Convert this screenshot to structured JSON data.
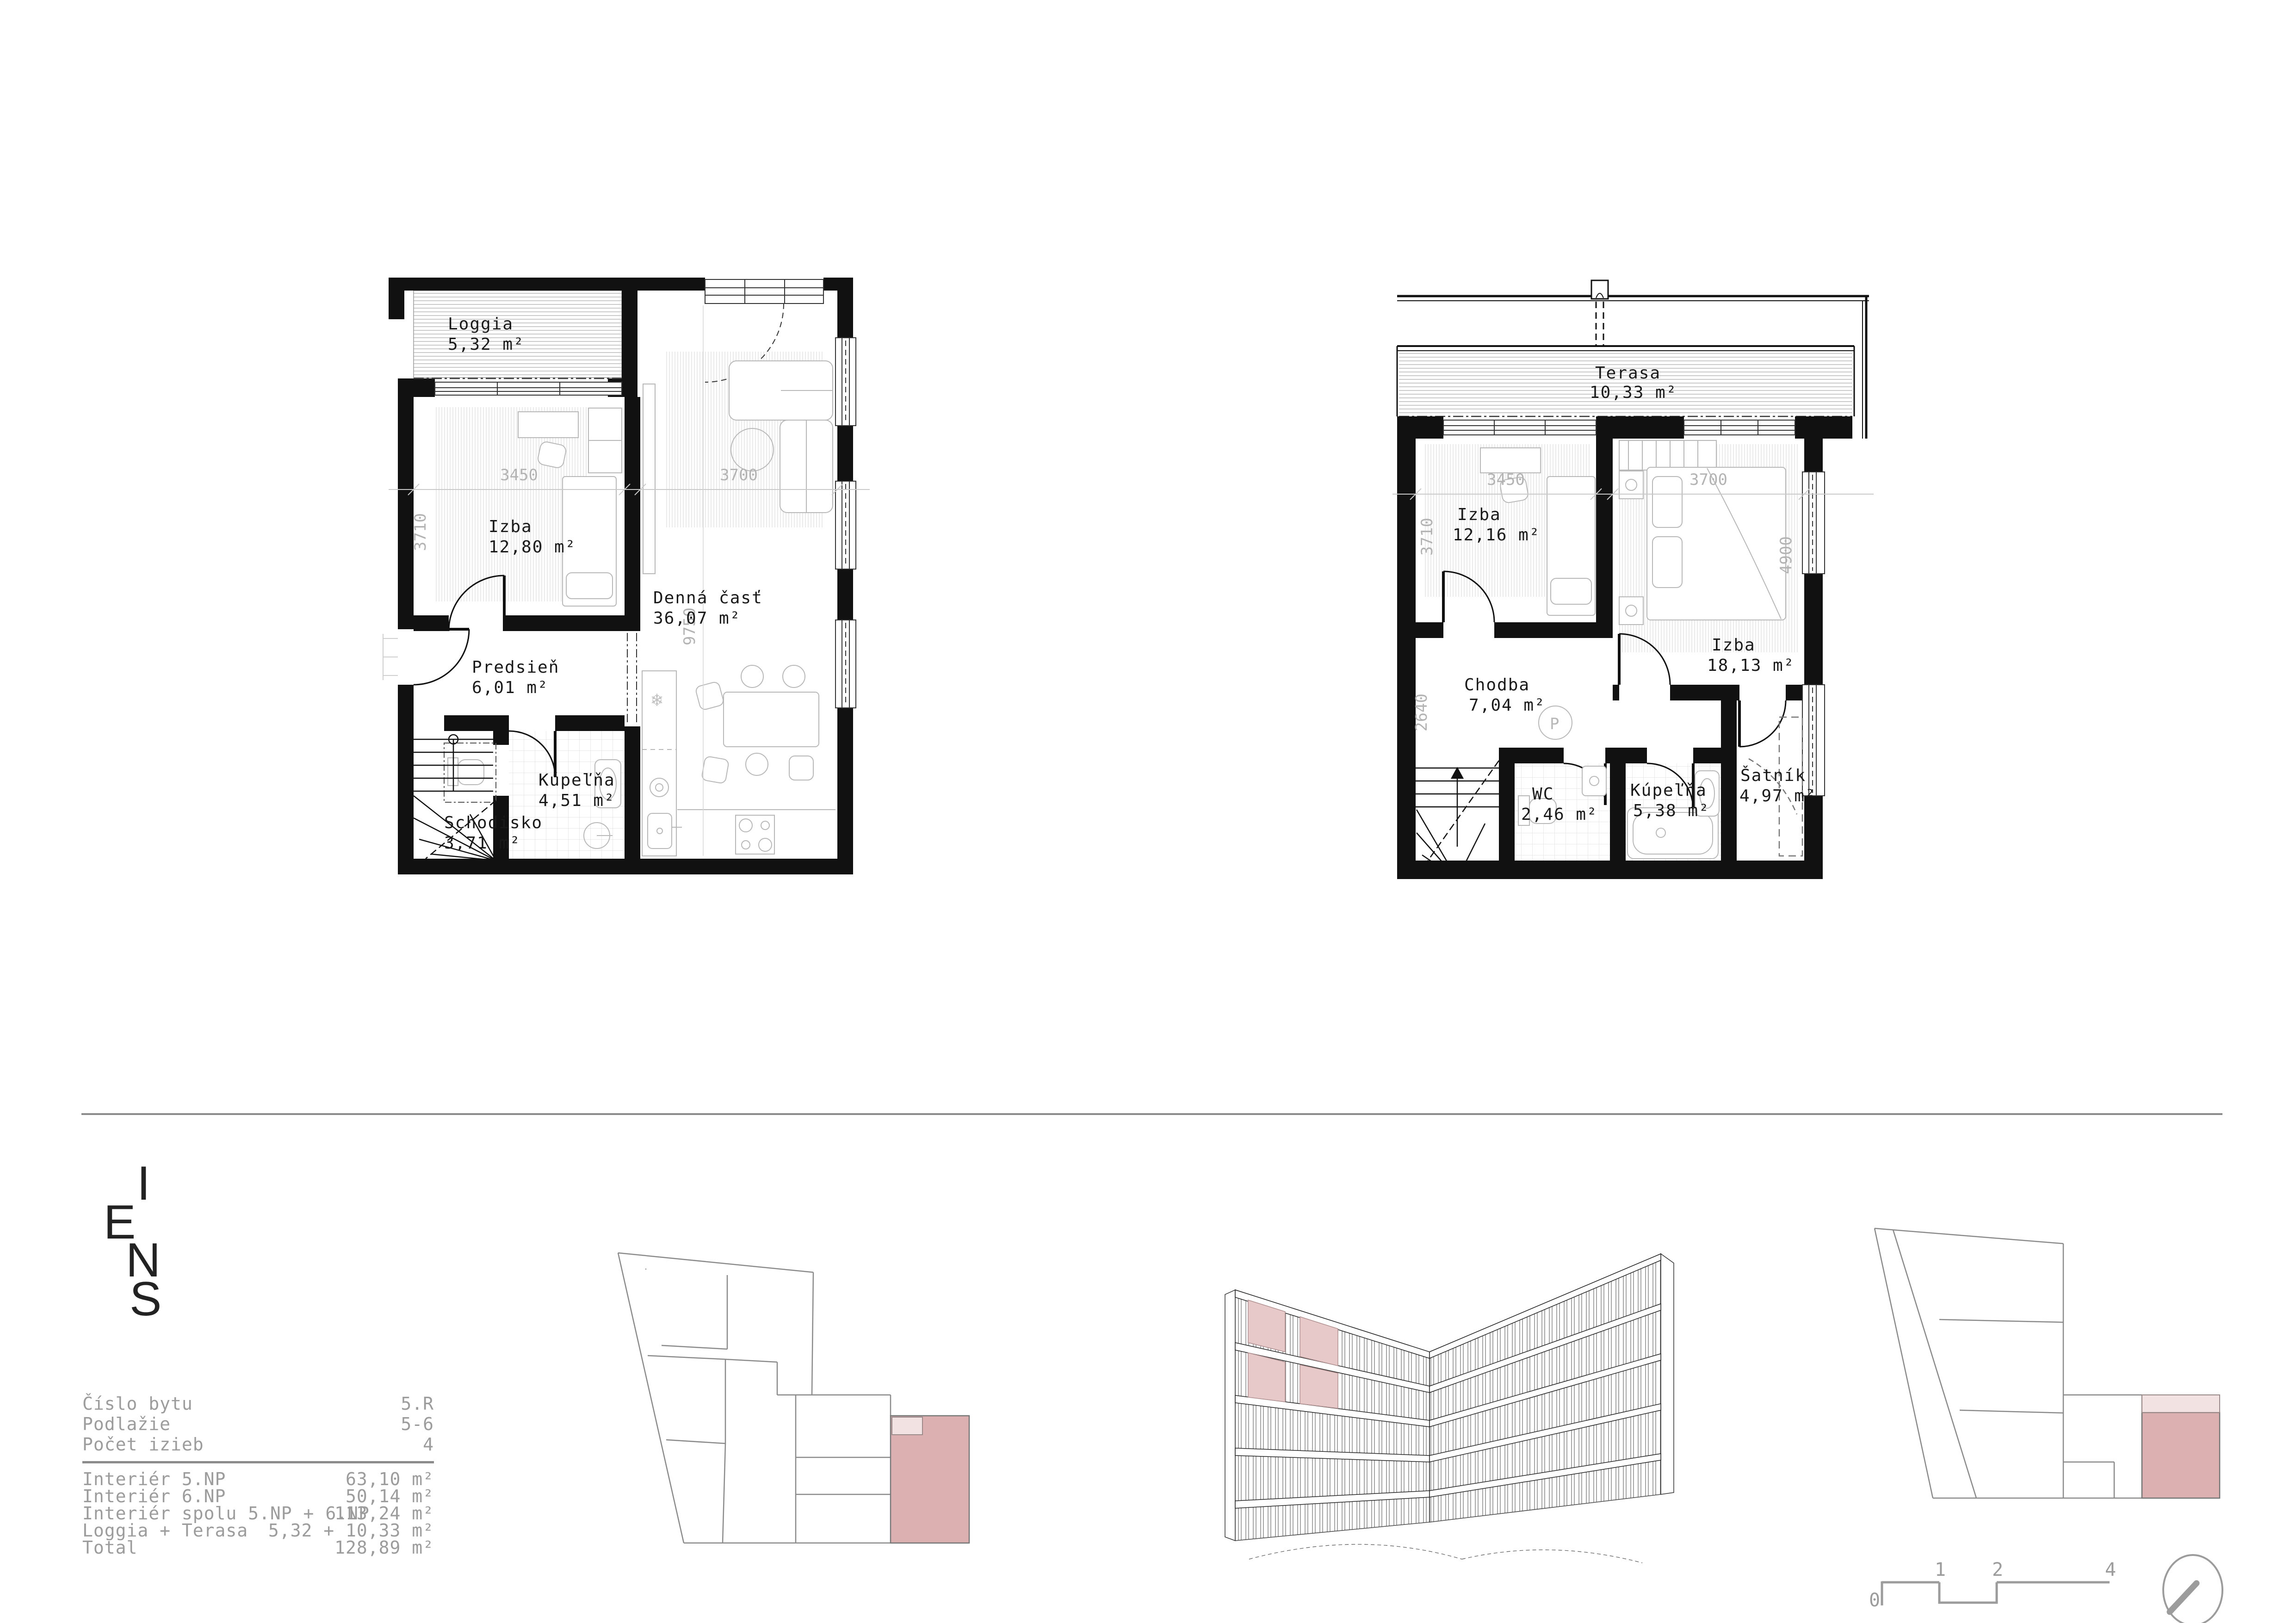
{
  "document_type": "apartment floor plan sheet",
  "colors": {
    "wall": "#111111",
    "furniture_gray": "#b8b8b8",
    "dim_gray": "#b3b3b3",
    "table_gray": "#9c9c9c",
    "keyplan_stroke": "#8a8a8a",
    "highlight_pink": "#dcb0b0",
    "highlight_pink_light": "#f2e2e2",
    "axon_pink": "#e7c9c9"
  },
  "plan5": {
    "rooms": {
      "loggia": {
        "name": "Loggia",
        "area": "5,32 m²"
      },
      "izba": {
        "name": "Izba",
        "area": "12,80 m²"
      },
      "denna": {
        "name": "Denná časť",
        "area": "36,07 m²"
      },
      "predsien": {
        "name": "Predsieň",
        "area": "6,01 m²"
      },
      "kupelna": {
        "name": "Kúpeľňa",
        "area": "4,51 m²"
      },
      "schodisko": {
        "name": "Schodisko",
        "area": "3,71 m²"
      }
    },
    "dims": {
      "w_left": "3450",
      "w_right": "3700",
      "h_left": "3710",
      "h_mid": "9750"
    }
  },
  "plan6": {
    "rooms": {
      "terasa": {
        "name": "Terasa",
        "area": "10,33 m²"
      },
      "izba1": {
        "name": "Izba",
        "area": "12,16 m²"
      },
      "izba2": {
        "name": "Izba",
        "area": "18,13 m²"
      },
      "chodba": {
        "name": "Chodba",
        "area": "7,04 m²"
      },
      "wc": {
        "name": "WC",
        "area": "2,46 m²"
      },
      "kupelna": {
        "name": "Kúpeľňa",
        "area": "5,38 m²"
      },
      "satnik": {
        "name": "Šatník",
        "area": "4,97 m²"
      }
    },
    "dims": {
      "w_left": "3450",
      "w_right": "3700",
      "h_left": "3710",
      "h_right": "4900",
      "h_chodba": "2640"
    },
    "washer_label": "P"
  },
  "logo": {
    "letters": [
      "I",
      "E",
      "N",
      "S"
    ]
  },
  "table": {
    "rows": [
      {
        "label": "Číslo bytu",
        "value": "5.R"
      },
      {
        "label": "Podlažie",
        "value": "5-6"
      },
      {
        "label": "Počet izieb",
        "value": "4"
      },
      {
        "label": "Interiér 5.NP",
        "value": "63,10 m²"
      },
      {
        "label": "Interiér 6.NP",
        "value": "50,14 m²"
      },
      {
        "label": "Interiér spolu 5.NP + 6.NP",
        "value": "113,24 m²"
      },
      {
        "label": "Loggia + Terasa",
        "value": "5,32 + 10,33 m²"
      },
      {
        "label": "Total",
        "value": "128,89 m²"
      }
    ]
  },
  "scalebar": {
    "labels": [
      "0",
      "1",
      "2",
      "4"
    ]
  }
}
